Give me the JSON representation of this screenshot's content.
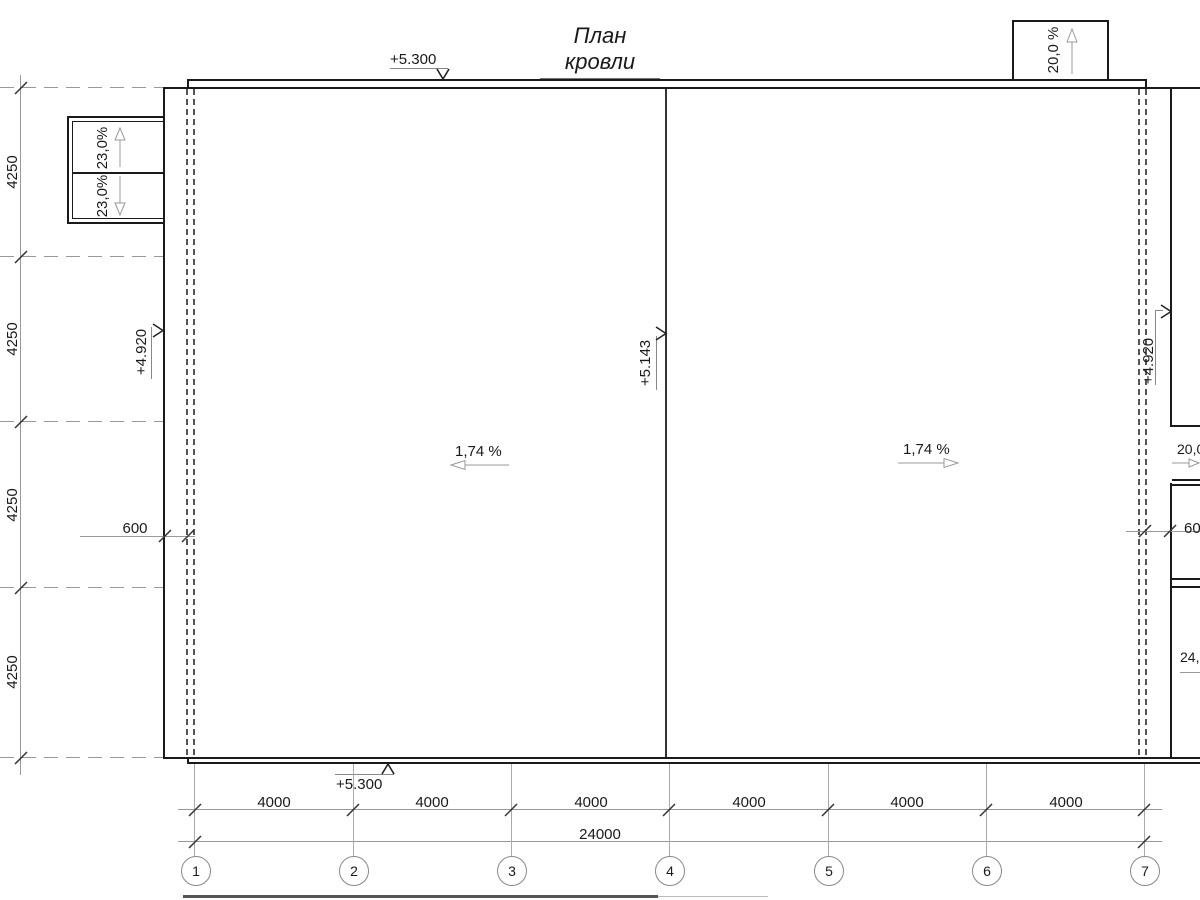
{
  "drawing": {
    "title": "План кровли"
  },
  "elevation_marks": {
    "eave_top": "+5.300",
    "eave_bottom": "+5.300",
    "roof_left": "+4.920",
    "roof_right": "+4.920",
    "ridge": "+5.143"
  },
  "slope_labels": {
    "left_roof_plane": "1,74 %",
    "right_roof_plane": "1,74 %",
    "left_canopy_upper": "23,0%",
    "left_canopy_lower": "23,0%",
    "top_right_canopy": "20,0 %",
    "right_canopy_upper": "20,0 %",
    "right_canopy_lower": "24,0 %"
  },
  "dimensions": {
    "overhang_left": "600",
    "overhang_right": "600",
    "total_width": "24000",
    "bay_widths": [
      "4000",
      "4000",
      "4000",
      "4000",
      "4000",
      "4000"
    ],
    "row_heights": [
      "4250",
      "4250",
      "4250",
      "4250"
    ]
  },
  "column_grid": {
    "labels": [
      "1",
      "2",
      "3",
      "4",
      "5",
      "6",
      "7"
    ]
  }
}
